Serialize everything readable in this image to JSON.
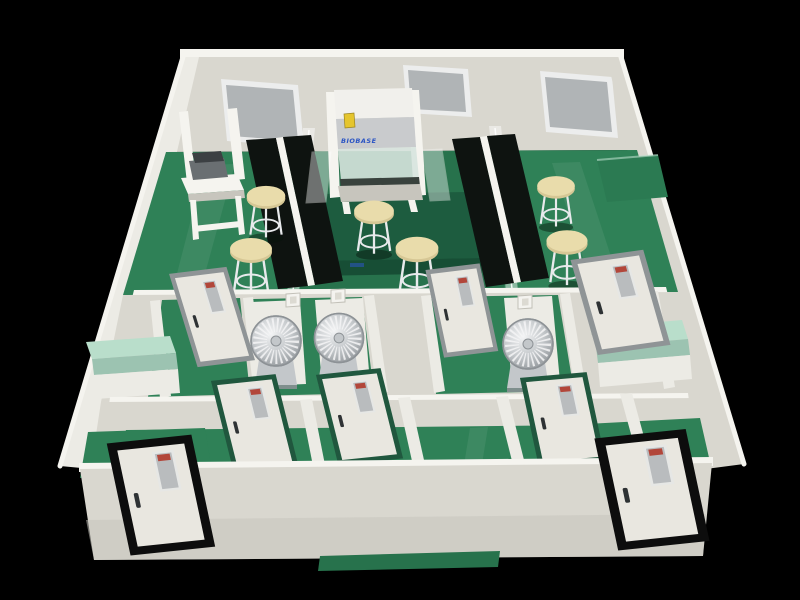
{
  "image": {
    "description": "3D cutaway rendering of a laboratory suite: green epoxy floors, cream walls, black workbenches with white reagent shelves, a biosafety cabinet, lab stools, fan-wheel devices in small middle rooms, and multiple framed doors",
    "view": "isometric cutaway from front above",
    "background": "#000000"
  },
  "palette": {
    "background": "#000000",
    "wall_top": "#f5f4ef",
    "wall_face": "#d9d7cf",
    "wall_shade": "#c7c5bd",
    "wall_bright": "#ecebe5",
    "floor_green": "#2f8157",
    "floor_dark": "#27724c",
    "floor_deep": "#1d5c3f",
    "floor_front": "#174e35",
    "bench_black": "#0e1310",
    "counter_mint": "#b9decb",
    "counter_mint_side": "#9cc3b1",
    "counter_green": "#2b7a52",
    "stool_seat": "#e9dcab",
    "stool_rim": "#d6c795",
    "stool_leg": "#e8eaec",
    "window_glass": "#b0b4b6",
    "window_frame": "#eceded",
    "door_face": "#e9e7e0",
    "frame_gray": "#8f9496",
    "frame_green": "#20573e",
    "frame_black": "#0d0d0d",
    "door_glass": "#b9bcbe",
    "sign_red": "#b2463a",
    "handle_dark": "#2e3234",
    "cabinet_hood": "#f1f0ec",
    "cabinet_band": "#c9cbcd",
    "cabinet_sash": "#d7e4de",
    "sticker_yellow": "#e5c52e",
    "logo_blue": "#2b55c4",
    "metal_light": "#f4f5f6",
    "metal_mid": "#c3c7ca",
    "metal_dark": "#8d9296",
    "instrument_dark": "#3c4043",
    "instrument_body": "#6a6f72",
    "switch_face": "#f4f3ef"
  },
  "areas": {
    "rear_laboratory": "open lab with black workbenches and stools",
    "center_bay": "biosafety-cabinet bay with dark green island table",
    "middle_rooms": "small equipment rooms with fan-wheel devices",
    "front_corridor": "corridor with green-frame doors",
    "entrances": "two black-frame entrance doors in the front wall"
  },
  "equipment": {
    "biosafety_cabinet": {
      "brand_text": "BIOBASE",
      "sticker": "yellow warning label"
    },
    "windows": 3,
    "stools": 6,
    "black_benches": 4,
    "fan_devices": 3,
    "light_switches": 3,
    "doors_gray_frame": 3,
    "doors_green_frame": 3,
    "doors_black_frame": 2,
    "mint_counters": 2,
    "benchtop_instrument": 1
  }
}
